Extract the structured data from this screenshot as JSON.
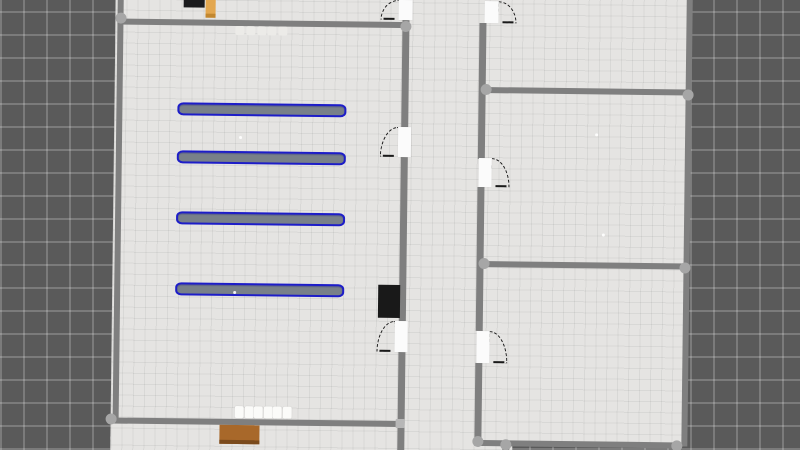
{
  "meta": {
    "view": "top-down-floor-plan",
    "has_text": false,
    "rotation_deg": 0.7
  },
  "colors": {
    "bg_base": "#5a5a5a",
    "bg_grid_line": "#7d7d7d",
    "floor": "#e5e4e2",
    "floor_grid_line": "#d7d6d4",
    "wall": "#7f7f7f",
    "joint_dot": "#a6a6a6",
    "door_white": "#fbfbfb",
    "swing_arc": "#1a1a1a",
    "shelf_outline": "#1d1dc8",
    "shelf_fill": "#788089",
    "black_block": "#1b1b1d",
    "dark_doorway": "#191919",
    "orange_plank": "#e3a74f",
    "orange_plank_dark": "#c2872f",
    "wood_table": "#a8682a",
    "wood_table_dark": "#7a4a1c",
    "chair_white": "#fbfbf9"
  },
  "scene": {
    "plan": {
      "x": 113,
      "y": -10,
      "w": 574,
      "h": 470
    },
    "floors": [
      {
        "name": "floor-main",
        "x": 0,
        "y": 0,
        "w": 574,
        "h": 453
      },
      {
        "name": "floor-bottom-left",
        "x": 0,
        "y": 450,
        "w": 402,
        "h": 20
      }
    ],
    "walls": [
      {
        "name": "wall-left-outer",
        "x": 2,
        "y": 0,
        "w": 6,
        "h": 434
      },
      {
        "name": "wall-left-room-top",
        "x": 2,
        "y": 32,
        "w": 292,
        "h": 6
      },
      {
        "name": "wall-left-room-bottom",
        "x": 0,
        "y": 431,
        "w": 294,
        "h": 6
      },
      {
        "name": "wall-corridor-left-a",
        "x": 287,
        "y": 30,
        "w": 7,
        "h": 107
      },
      {
        "name": "wall-corridor-left-b",
        "x": 287,
        "y": 167,
        "w": 7,
        "h": 164
      },
      {
        "name": "wall-corridor-left-c",
        "x": 287,
        "y": 362,
        "w": 7,
        "h": 108
      },
      {
        "name": "wall-corridor-right-a",
        "x": 364,
        "y": 32,
        "w": 7,
        "h": 136
      },
      {
        "name": "wall-corridor-right-b",
        "x": 364,
        "y": 196,
        "w": 7,
        "h": 144
      },
      {
        "name": "wall-corridor-right-c",
        "x": 364,
        "y": 372,
        "w": 7,
        "h": 79
      },
      {
        "name": "wall-right-divider-top",
        "x": 368,
        "y": 96,
        "w": 206,
        "h": 6
      },
      {
        "name": "wall-right-divider-mid",
        "x": 368,
        "y": 270,
        "w": 206,
        "h": 6
      },
      {
        "name": "wall-right-outer",
        "x": 571,
        "y": 0,
        "w": 6,
        "h": 453
      },
      {
        "name": "wall-bottom-right",
        "x": 364,
        "y": 449,
        "w": 206,
        "h": 6
      },
      {
        "name": "wall-bottom-stub",
        "x": 392,
        "y": 451,
        "w": 7,
        "h": 19
      }
    ],
    "doors": [
      {
        "name": "door-corridor-top-left",
        "x": 283,
        "y": 10,
        "w": 14,
        "h": 20,
        "swing": "left"
      },
      {
        "name": "door-corridor-top-right",
        "x": 369,
        "y": 10,
        "w": 14,
        "h": 22,
        "swing": "right"
      },
      {
        "name": "door-left-room-mid",
        "x": 284,
        "y": 137,
        "w": 13,
        "h": 30,
        "swing": "left"
      },
      {
        "name": "door-right-room-upper",
        "x": 365,
        "y": 167,
        "w": 13,
        "h": 29,
        "swing": "right"
      },
      {
        "name": "door-left-room-lower",
        "x": 283,
        "y": 331,
        "w": 13,
        "h": 31,
        "swing": "left"
      },
      {
        "name": "door-right-room-lower",
        "x": 365,
        "y": 340,
        "w": 13,
        "h": 32,
        "swing": "right"
      }
    ],
    "joints": [
      {
        "name": "joint-top-left",
        "x": 5,
        "y": 31,
        "shape": "round"
      },
      {
        "name": "joint-bottom-left",
        "x": 0,
        "y": 432,
        "shape": "round"
      },
      {
        "name": "joint-top-corridor",
        "x": 290,
        "y": 36,
        "shape": "round"
      },
      {
        "name": "joint-div-top-left",
        "x": 371,
        "y": 98,
        "shape": "round"
      },
      {
        "name": "joint-div-top-right",
        "x": 573,
        "y": 101,
        "shape": "round"
      },
      {
        "name": "joint-div-mid-left",
        "x": 371,
        "y": 272,
        "shape": "round"
      },
      {
        "name": "joint-div-mid-right",
        "x": 572,
        "y": 274,
        "shape": "round"
      },
      {
        "name": "joint-bottom-right",
        "x": 566,
        "y": 452,
        "shape": "round"
      },
      {
        "name": "joint-bottom-stub",
        "x": 395,
        "y": 453,
        "shape": "round"
      },
      {
        "name": "joint-corridor-bend",
        "x": 367,
        "y": 450,
        "shape": "round"
      },
      {
        "name": "joint-t-junction",
        "x": 290,
        "y": 434,
        "shape": "square"
      }
    ],
    "shelves": [
      {
        "name": "shelf-row-1",
        "x": 63,
        "y": 115,
        "w": 169,
        "h": 13
      },
      {
        "name": "shelf-row-2",
        "x": 63,
        "y": 163,
        "w": 169,
        "h": 13
      },
      {
        "name": "shelf-row-3",
        "x": 63,
        "y": 224,
        "w": 169,
        "h": 13
      },
      {
        "name": "shelf-row-4",
        "x": 63,
        "y": 295,
        "w": 169,
        "h": 13
      }
    ],
    "furniture": [
      {
        "name": "black-crate",
        "x": 68,
        "y": 4,
        "w": 21,
        "h": 16,
        "fill": "black_block"
      },
      {
        "name": "orange-plank",
        "x": 90,
        "y": 2,
        "w": 10,
        "h": 24,
        "fill": "orange_plank",
        "edge": "orange_plank_dark"
      },
      {
        "name": "dark-doorway",
        "x": 266,
        "y": 295,
        "w": 22,
        "h": 33,
        "fill": "dark_doorway"
      },
      {
        "name": "wood-table",
        "x": 109,
        "y": 437,
        "w": 40,
        "h": 15,
        "fill": "wood_table",
        "edge": "wood_table_dark"
      }
    ],
    "small_items": [
      {
        "name": "counter-item",
        "x": 120,
        "y": 38,
        "w": 9,
        "h": 9,
        "style": "faint"
      },
      {
        "name": "counter-item",
        "x": 131,
        "y": 38,
        "w": 9,
        "h": 9,
        "style": "faint"
      },
      {
        "name": "counter-item",
        "x": 142,
        "y": 38,
        "w": 9,
        "h": 9,
        "style": "faint"
      },
      {
        "name": "counter-item",
        "x": 152,
        "y": 38,
        "w": 9,
        "h": 9,
        "style": "faint"
      },
      {
        "name": "counter-item",
        "x": 163,
        "y": 38,
        "w": 9,
        "h": 9,
        "style": "faint"
      },
      {
        "name": "chair-item",
        "x": 124,
        "y": 418,
        "w": 9,
        "h": 12,
        "style": "bright"
      },
      {
        "name": "chair-item",
        "x": 134,
        "y": 418,
        "w": 9,
        "h": 12,
        "style": "bright"
      },
      {
        "name": "chair-item",
        "x": 143,
        "y": 418,
        "w": 9,
        "h": 12,
        "style": "bright"
      },
      {
        "name": "chair-item",
        "x": 153,
        "y": 418,
        "w": 9,
        "h": 12,
        "style": "bright"
      },
      {
        "name": "chair-item",
        "x": 162,
        "y": 418,
        "w": 9,
        "h": 12,
        "style": "bright"
      },
      {
        "name": "chair-item",
        "x": 172,
        "y": 418,
        "w": 9,
        "h": 12,
        "style": "bright"
      }
    ],
    "specks": [
      {
        "name": "floor-speck",
        "x": 125,
        "y": 148
      },
      {
        "name": "floor-speck",
        "x": 121,
        "y": 303
      },
      {
        "name": "floor-speck",
        "x": 481,
        "y": 141
      },
      {
        "name": "floor-speck",
        "x": 489,
        "y": 241
      }
    ]
  }
}
